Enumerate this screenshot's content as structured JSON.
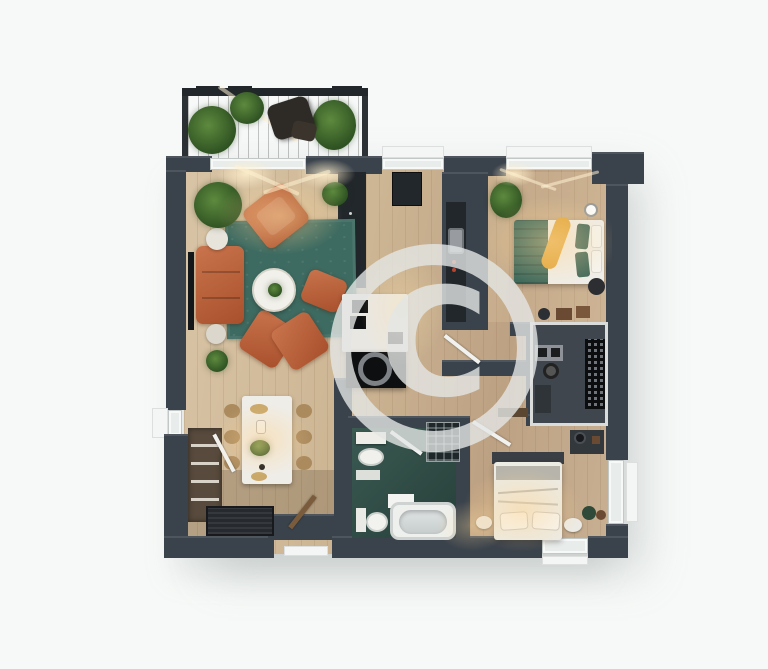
{
  "image_type": "3d-rendered-apartment-floor-plan-top-view",
  "watermark": {
    "symbol": "C",
    "style": "circled-copyright-watermark"
  },
  "palette": {
    "bg": "#f7f9f8",
    "wall": "#3a424b",
    "wall-dark": "#22272c",
    "rug": "#3e6b61",
    "sofa-a": "#c9744c",
    "sofa-b": "#a8502c",
    "bed-teal": "#3f6a5c",
    "bath-a": "#3a5a52",
    "bath-b": "#273f3a",
    "closet-floor": "#3f464d",
    "accent-yellow": "#e0a63c",
    "white-furn": "#efede8",
    "black-furn": "#0e0f10",
    "plant-a": "#5d8a3e",
    "plant-b": "#2f5222",
    "balcony-a": "#7d5f3a",
    "balcony-b": "#55401f",
    "watermark": "rgba(227,230,229,0.8)"
  },
  "rooms": [
    {
      "id": "balcony",
      "features": [
        "wood-deck",
        "railing",
        "potted-plants",
        "lounge-chair"
      ]
    },
    {
      "id": "living-room",
      "features": [
        "orange-sofa",
        "two-orange-armchairs",
        "corner-loveseat",
        "round-coffee-table-with-plant",
        "teal-area-rug",
        "tv-unit",
        "side-tables",
        "floor-plants"
      ]
    },
    {
      "id": "dining-area",
      "features": [
        "white-dining-table",
        "six-chairs",
        "centerpiece-plant",
        "tableware"
      ]
    },
    {
      "id": "kitchen",
      "features": [
        "white-island-with-cooktop",
        "black-lower-unit",
        "tall-cabinet",
        "fridge",
        "dark-counter-with-sink"
      ]
    },
    {
      "id": "hallway",
      "features": [
        "interior-doors",
        "console-table"
      ]
    },
    {
      "id": "bedroom-1",
      "features": [
        "double-bed",
        "teal-duvet",
        "teal-pillows",
        "yellow-throw-blanket",
        "potted-plant",
        "bedside-table"
      ]
    },
    {
      "id": "walk-in-closet",
      "features": [
        "wardrobe-rack",
        "shelving",
        "storage-boxes"
      ]
    },
    {
      "id": "bathroom",
      "features": [
        "bathtub",
        "toilet",
        "wash-basin",
        "vanity",
        "walk-in-shower",
        "teal-floor"
      ]
    },
    {
      "id": "bedroom-2",
      "features": [
        "double-bed",
        "white-bedding",
        "pillows",
        "two-nightstands",
        "dresser-with-lamp",
        "potted-plant"
      ]
    },
    {
      "id": "entrance",
      "features": [
        "doormat",
        "shoe-cabinet",
        "entry-door"
      ]
    }
  ]
}
